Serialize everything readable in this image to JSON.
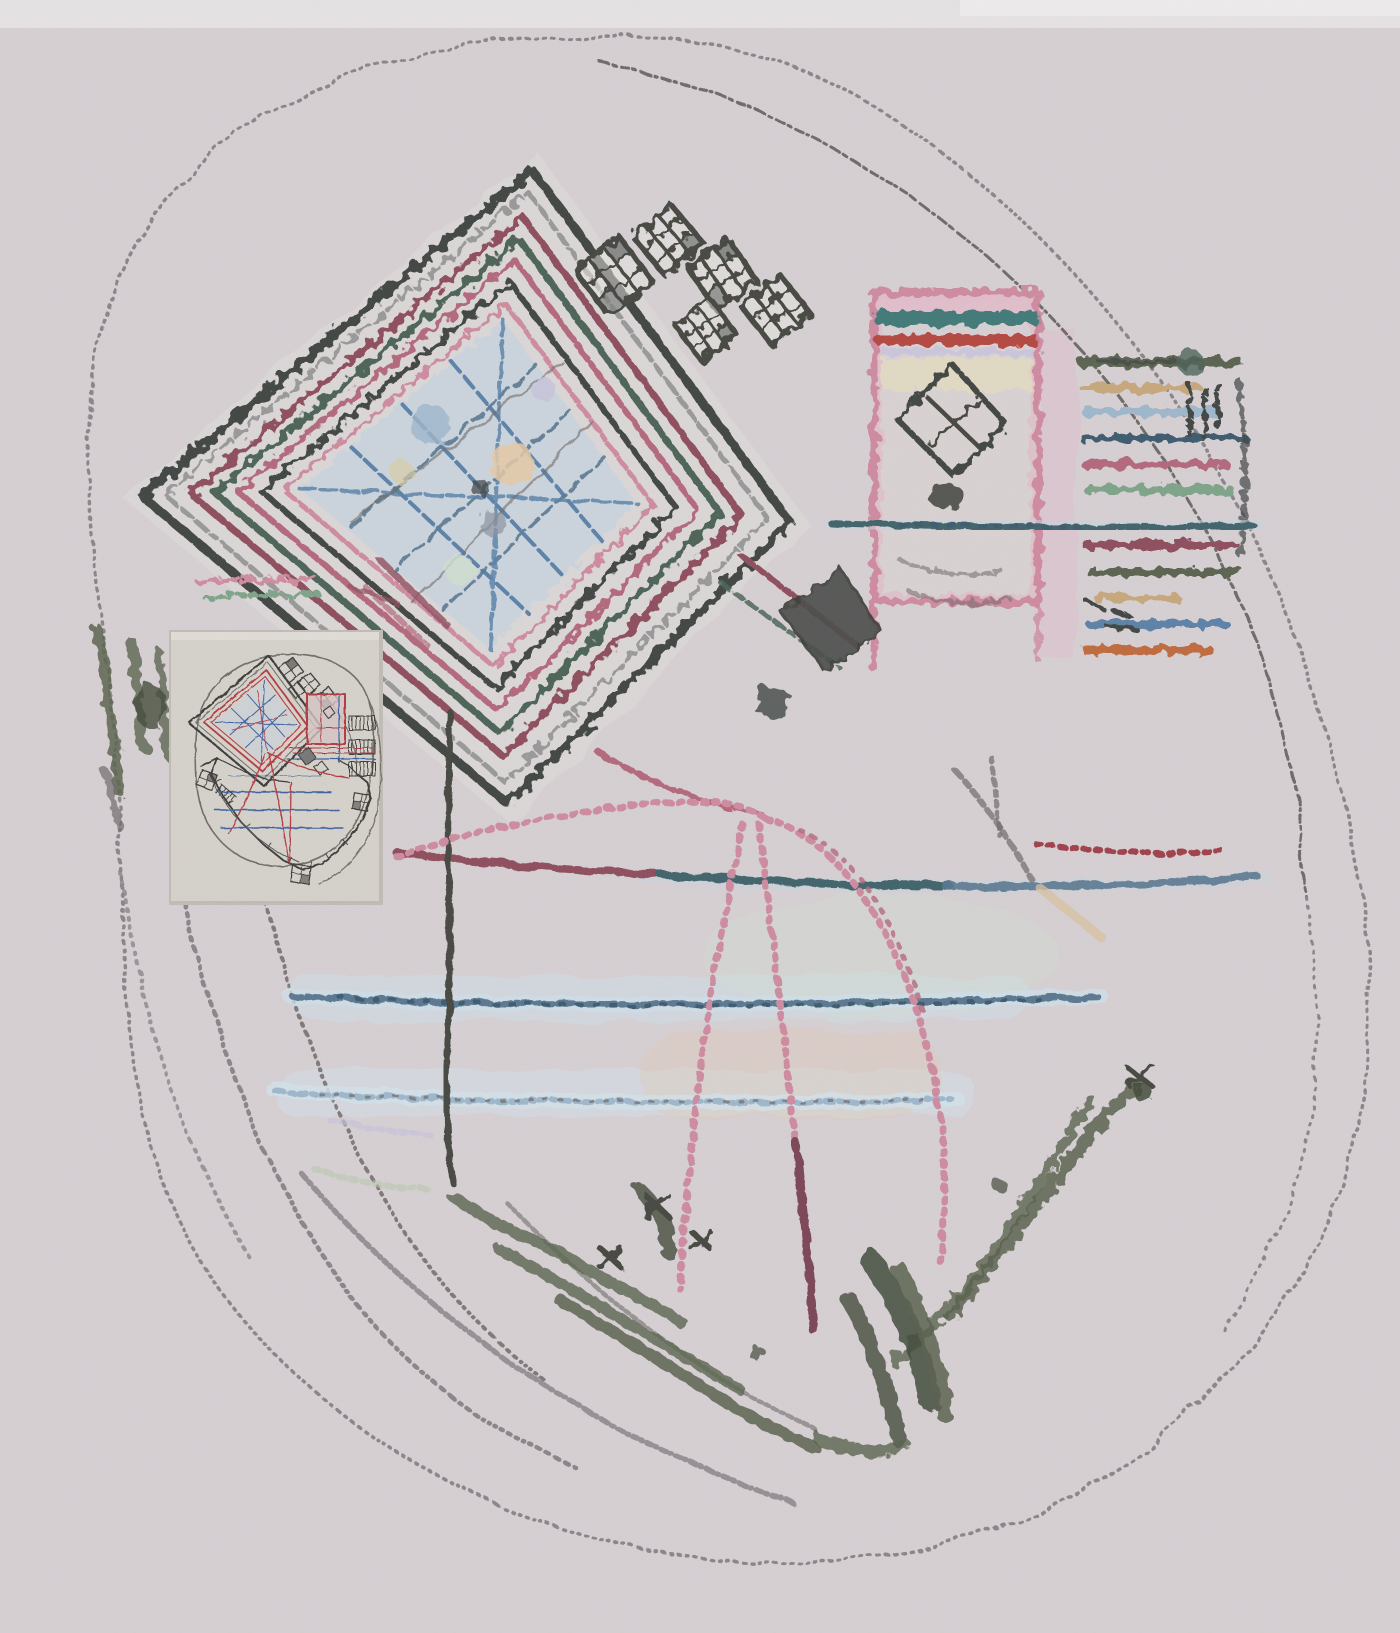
{
  "meta": {
    "kind": "hand-drawn architectural site plan sketch, photographed",
    "medium": "crayon and colored pencil over soft graphite on pale pinkish-gray paper",
    "text_content": "none - the image contains no legible text, labels, numbers or UI chrome",
    "inset_note": "a small printed line-drawing version of the same plan is pinned over the lower-left of the sketch"
  },
  "palette": {
    "paper": "#d7d1d4",
    "paper-light": "#eae7e8",
    "inset-paper": "#d6d2cb",
    "inset-edge": "#c2bcb6",
    "pencil": "#8b8589",
    "graphite": "#6e6a68",
    "ink": "#3f4542",
    "charcoal": "#45463f",
    "gray": "#8a8a8a",
    "maroon": "#8e4e5c",
    "dark-red": "#a04049",
    "rose": "#b4687c",
    "pink": "#cf8ba0",
    "pink-pale": "#e3bccb",
    "red": "#b5463f",
    "teal": "#3f7a78",
    "teal-dim": "#41636a",
    "green": "#4c6456",
    "green-soft": "#7ea488",
    "olive": "#5a6350",
    "tree": "#59624e",
    "tree-dark": "#414a3a",
    "blue": "#5b82a8",
    "slate": "#5a7890",
    "slate-dark": "#3e5a6e",
    "sky": "#9fb8cc",
    "blue-halo": "#c9d6de",
    "blue-pale": "#d3e2ea",
    "sky-wash": "#cfe0ea",
    "orange": "#c06a3c",
    "tan": "#c8a87c",
    "peach": "#e6c9a6",
    "mint": "#cfe0cf",
    "lavender": "#c9c4dc",
    "inset-line": "#3a3a38",
    "inset-red": "#b03a40",
    "inset-blue": "#3a5f9e",
    "inset-gray": "#6f6d68"
  },
  "scene": {
    "elements": [
      {
        "name": "site-boundary-outline",
        "desc": "large irregular rounded loop in dotted gray pencil enclosing the whole plan"
      },
      {
        "name": "inner-terrace-arcs",
        "desc": "concentric dotted pencil arcs top-right and lower-left"
      },
      {
        "name": "main-hall-diamond",
        "desc": "large rotated-square hall of concentric crayon outlines (black, gray, maroon, dark green, rose, pink) with pale blue floor and blue/graphite lattice"
      },
      {
        "name": "stepped-pavilion-chain",
        "desc": "chain of small checkered rotated squares stepping along the top edge"
      },
      {
        "name": "courtyard-block",
        "desc": "pink-outlined rectangular court with teal and red stripes at top and a dark outlined diamond inside"
      },
      {
        "name": "striped-wing",
        "desc": "stack of short horizontal crayon stripes at far right: olive, tan, sky, rose, green, maroon, blue, orange"
      },
      {
        "name": "central-dark-diamond",
        "desc": "solid dark gray rotated square at plan center"
      },
      {
        "name": "multicolor-path-line",
        "desc": "long dashed line crossing the plan: maroon then teal then slate blue"
      },
      {
        "name": "blue-path-lines",
        "desc": "two dashed slate/light-blue horizontal walk lines with pale halos"
      },
      {
        "name": "vertical-spine-line",
        "desc": "dark dashed vertical line dropping from the hall"
      },
      {
        "name": "pink-walkways",
        "desc": "dotted pink/rose curves radiating from the hall down the slope"
      },
      {
        "name": "vegetation-scribbles",
        "desc": "dark olive-green tree scribbles forming a V band at bottom and a grove at left"
      },
      {
        "name": "inset-plan",
        "desc": "small clean ink plan with black stepped outlines, double red square, blue floor lines, red walkway curves and comb-like service bars"
      }
    ]
  }
}
